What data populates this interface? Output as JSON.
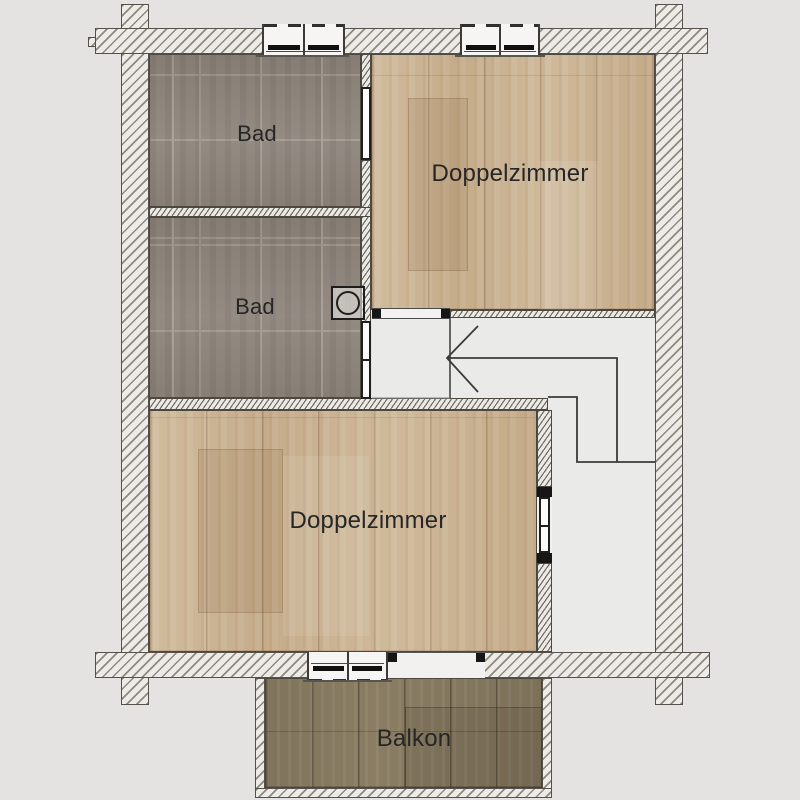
{
  "plan_title": "floor-plan",
  "rooms": {
    "bad1": {
      "label": "Bad",
      "floor": "tile"
    },
    "bad2": {
      "label": "Bad",
      "floor": "tile"
    },
    "doppelzimmer1": {
      "label": "Doppelzimmer",
      "floor": "wood"
    },
    "doppelzimmer2": {
      "label": "Doppelzimmer",
      "floor": "wood"
    },
    "balkon": {
      "label": "Balkon",
      "floor": "wood-dark"
    },
    "hall": {
      "label": "",
      "floor": "plain"
    }
  },
  "symbols": {
    "washing_machine": "washing-machine",
    "stair_direction": "stair-walk-line-with-arrow",
    "windows": [
      "window-top-bad",
      "window-top-doppelzimmer",
      "window-bottom-doppelzimmer"
    ],
    "doors": [
      "door-bad1-ensuite",
      "door-bad2-hall",
      "door-doppelzimmer1-open",
      "door-doppelzimmer2",
      "door-balcony-open"
    ]
  },
  "colors": {
    "background": "#e4e3e1",
    "wall_fill": "#edebe7",
    "wall_hatch": "#8e897f",
    "tile_floor": "#8e857c",
    "wood_floor": "#cbb493",
    "balcony_floor": "#8a7d63",
    "hall_floor": "#eaeae8",
    "line": "#3a3a3a",
    "text": "#262626"
  }
}
